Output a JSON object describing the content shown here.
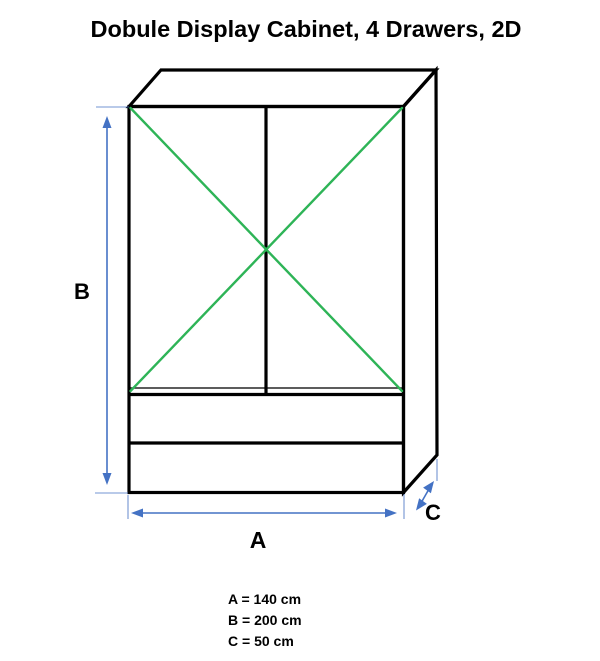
{
  "title": "Dobule Display Cabinet, 4 Drawers, 2D",
  "diagram": {
    "type": "furniture-dimension-drawing",
    "object": "double display cabinet with 4 drawers",
    "labels": {
      "width_label": "A",
      "height_label": "B",
      "depth_label": "C"
    },
    "dimensions": {
      "A": "140 cm",
      "B": "200 cm",
      "C": "50 cm"
    }
  },
  "legend": {
    "line_a": "A = 140 cm",
    "line_b": "B = 200 cm",
    "line_c": "C = 50 cm"
  },
  "colors": {
    "line": "#000000",
    "brace": "#2eb457",
    "dimension": "#4472c4",
    "background": "#ffffff"
  }
}
